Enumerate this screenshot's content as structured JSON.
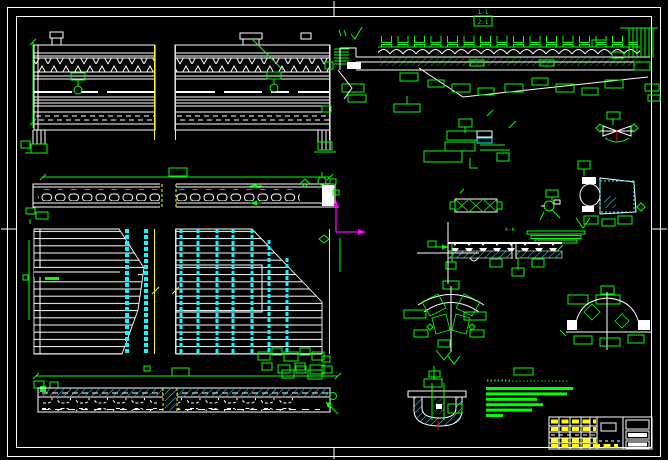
{
  "app": {
    "description": "CAD drawing canvas, bridge girder working drawings"
  },
  "colors": {
    "bg": "#000000",
    "green": "#00ff00",
    "white": "#ffffff",
    "cyan": "#00ffff",
    "yellow": "#ffff00",
    "magenta": "#ff00ff",
    "red": "#ff0000"
  },
  "labels": {
    "section_1": "1-1",
    "section_1_scale": "2:1",
    "section_k": "k-k"
  },
  "notes": {
    "lines": [
      87,
      81,
      51,
      57,
      46,
      17
    ]
  },
  "views": [
    "girder-elevation-left",
    "girder-elevation-right",
    "beam-side-elevation",
    "deck-plan-left",
    "deck-plan-right",
    "void-slab-longitudinal-section",
    "bridge-cross-section",
    "bearing-assembly-detail",
    "bowtie-joint-detail",
    "bearing-x-elevation",
    "anchor-detail",
    "curb-section-detail",
    "k-k-section",
    "pier-cap-detail",
    "abutment-detail",
    "drain-detail"
  ]
}
